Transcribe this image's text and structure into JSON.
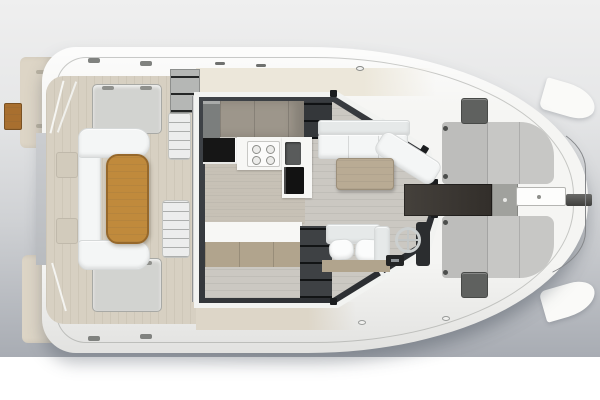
{
  "scene": {
    "title": "catamaran-deck-plan-top-view",
    "description": "Top-down 3D rendering of a catamaran yacht showing aft cockpit, salon with galley and helm, and foredeck sunpads",
    "background": {
      "top": "#efefef",
      "mid": "#cfd1d4",
      "bottom": "#a8acb3",
      "margin": "#ffffff"
    },
    "palette": {
      "hull": "#f5f5f3",
      "deck": "#d7d0c2",
      "deck_light": "#ece7da",
      "transom": "#ddd5c6",
      "wood_step": "#a86f2f",
      "teak": "#c08a3c",
      "bench": "#d2d3d0",
      "stair": "#eceded",
      "divider": "#b4b6b6",
      "module_gray": "#b5b7b5",
      "roof_band": "#f2f3f1",
      "frame": "#303337",
      "floor": "#cbc8c2",
      "galley_floor": "#c7c0b4",
      "galley_wood": "#9d968b",
      "cabinet_gray": "#7b7e7d",
      "counter_black": "#161616",
      "counter_white": "#f7f7f5",
      "sink": "#595b5b",
      "appliance": "#121212",
      "lockers_dark": "#34373a",
      "cushion": "#f4f6f6",
      "cushion_back": "#e6e9e9",
      "table_wood": "#b9ab94",
      "shelf_dark": "#3e4144",
      "nav_wood": "#b1a48d",
      "console": "#232425",
      "helm_panel": "#2b2d2f",
      "walkway": "#3a3733",
      "pad_square": "#a0a19d",
      "locker_white": "#fdfdfc",
      "sunpad": "#c7c7c5",
      "fore_hatch": "#5f615f",
      "bowsprit": "#5a5a58",
      "wing": "#fafaf8"
    },
    "components": [
      "aft-swim-platforms",
      "teak-boarding-step",
      "aft-deck",
      "deck-bench-hatches",
      "cockpit-sofa",
      "cockpit-teak-table",
      "companionway-stairs",
      "sliding-door-divider",
      "salon-window-frame",
      "galley-cabinets",
      "galley-stove",
      "galley-sink",
      "galley-oven",
      "galley-counters",
      "salon-sofa",
      "salon-table",
      "storage-shelves",
      "nav-seat",
      "helm-wheel",
      "helm-console",
      "center-walkway",
      "anchor-locker",
      "foredeck-sunpads",
      "foredeck-hatches",
      "bowsprit",
      "bow-hull-tips",
      "side-deck-rails"
    ]
  }
}
